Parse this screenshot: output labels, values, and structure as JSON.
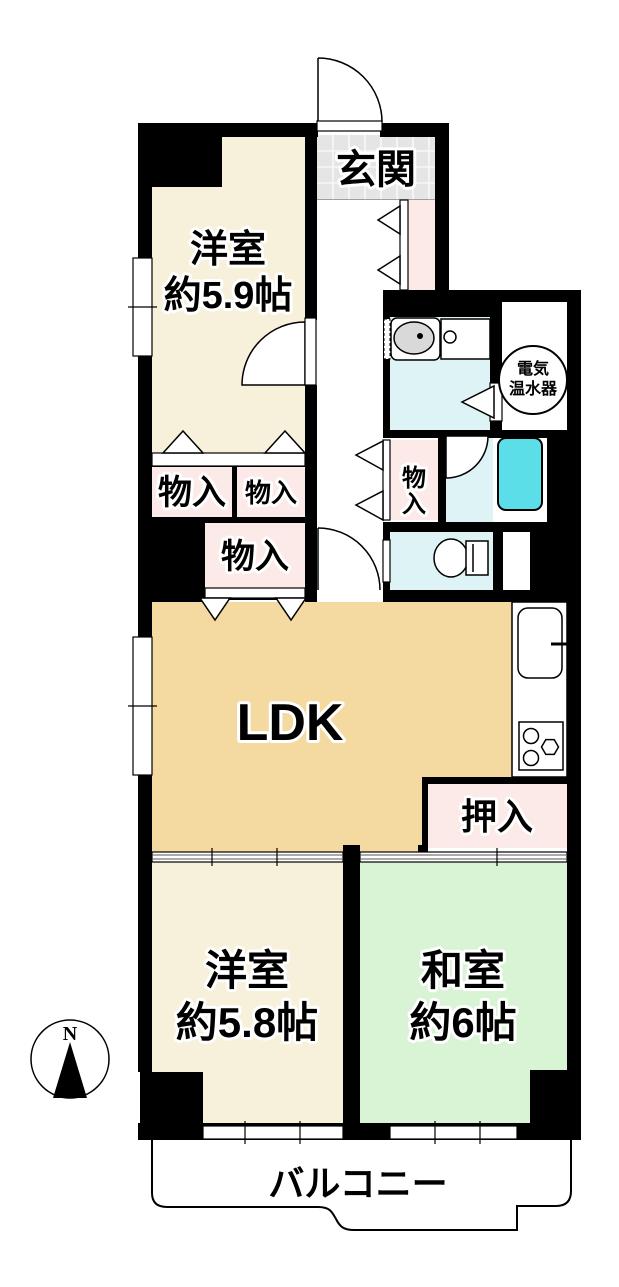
{
  "floorplan": {
    "labels": {
      "genkan": "玄関",
      "western_room_1_name": "洋室",
      "western_room_1_size": "約5.9帖",
      "storage_1": "物入",
      "storage_2": "物入",
      "storage_3": "物入",
      "storage_4_char_1": "物",
      "storage_4_char_2": "入",
      "water_heater_line_1": "電気",
      "water_heater_line_2": "温水器",
      "ldk": "LDK",
      "oshiire": "押入",
      "western_room_2_name": "洋室",
      "western_room_2_size": "約5.8帖",
      "japanese_room_name": "和室",
      "japanese_room_size": "約6帖",
      "balcony": "バルコニー",
      "compass_north": "N"
    },
    "colors": {
      "wall": "#000000",
      "western_room_floor": "#F7F0DB",
      "ldk_floor": "#F4D9A1",
      "japanese_room_floor": "#D9F3D5",
      "closet_floor": "#FCEAE8",
      "wet_area_floor": "#DDF3F5",
      "bathtub": "#5CDEE8",
      "entrance_tile": "#E5E5E5",
      "fixture_gray": "#D9D9D9"
    }
  }
}
